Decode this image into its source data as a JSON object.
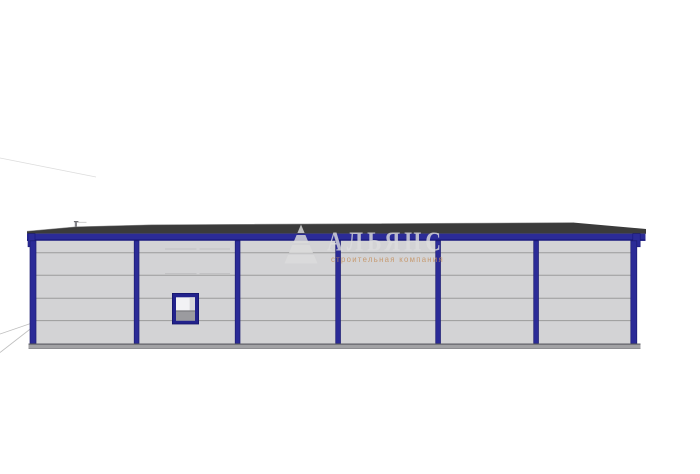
{
  "watermark": {
    "company_name": "АЛЬЯНС",
    "tagline": "строительная компания",
    "logo": "pyramid-logo"
  },
  "scene": {
    "bays": 6,
    "panel_rows": 5,
    "windows": 1
  },
  "colors": {
    "background": "#ffffff",
    "wall_panel": "#d3d3d5",
    "panel_seam": "#9b9b9b",
    "panel_seam_light": "#c2c2c4",
    "steel_blue": "#2b2b97",
    "steel_blue_dark": "#17177a",
    "roof_dark": "#3b3b3b",
    "roof_edge_light": "#8a8a8a",
    "plinth_gray": "#a2a2a5",
    "plinth_edge": "#5f5f66",
    "window_frame_blue": "#22228c",
    "window_glass": "#f2f2f4",
    "window_glass_shade": "#d8d8db",
    "window_sill": "#9b9b9f",
    "watermark_gray": "#dedede",
    "watermark_tagline": "#c5915f",
    "artifact_line": "#a8a8a8"
  }
}
